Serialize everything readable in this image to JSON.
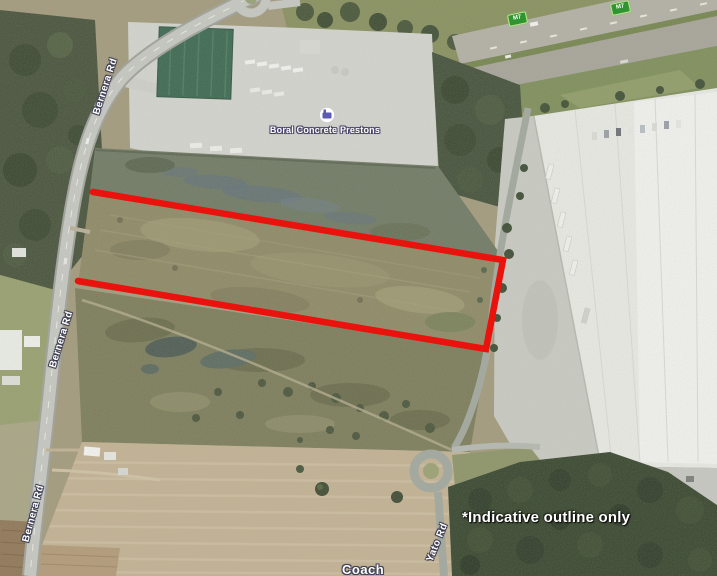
{
  "map": {
    "kind": "satellite-aerial",
    "poi": {
      "label": "Boral Concrete Prestons",
      "marker": "business-poi-marker-icon"
    },
    "road_labels": {
      "bernera_top": "Bernera Rd",
      "bernera_mid": "Bernera Rd",
      "bernera_bottom": "Bernera Rd",
      "yato": "Yato Rd",
      "partial_bottom": "Coach"
    },
    "route_shields": {
      "shield_1": "M7",
      "shield_2": "M7"
    },
    "annotation": {
      "text": "*Indicative outline only",
      "color": "#ffffff"
    },
    "outline": {
      "color": "#ea120d",
      "meaning": "indicative site boundary"
    },
    "colors": {
      "shield_green": "#319432",
      "label_halo": "#3f3f55"
    }
  }
}
